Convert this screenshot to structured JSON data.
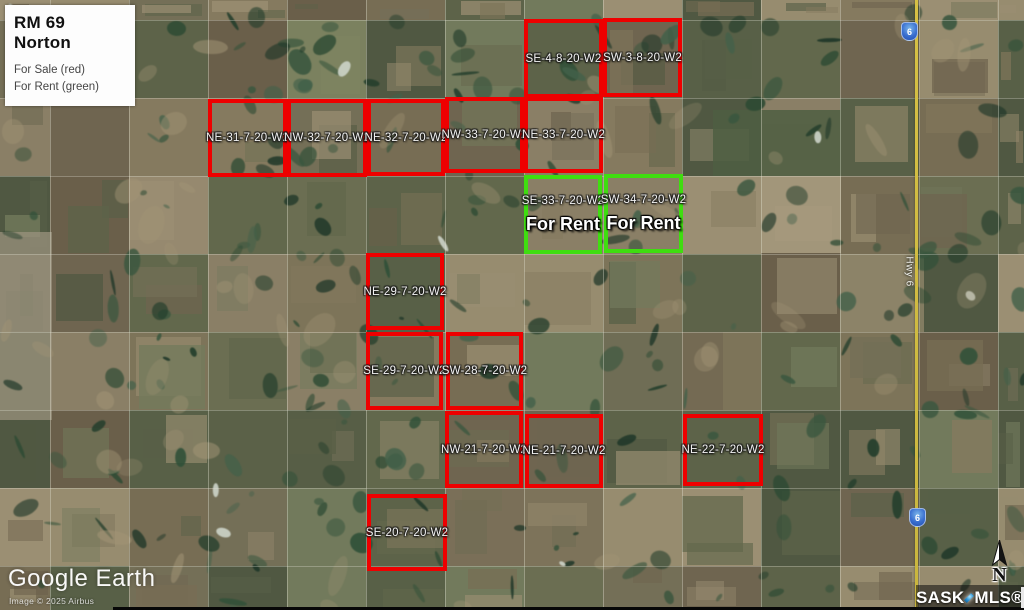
{
  "legend": {
    "title": "RM 69 Norton",
    "line1": "For Sale (red)",
    "line2": "For Rent (green)"
  },
  "colors": {
    "sale": "#ee0000",
    "rent": "#3fdd10"
  },
  "parcels": [
    {
      "label": "SE-4-8-20-W2",
      "status": "sale",
      "x": 524,
      "y": 19,
      "w": 79,
      "h": 79
    },
    {
      "label": "SW-3-8-20-W2",
      "status": "sale",
      "x": 603,
      "y": 18,
      "w": 79,
      "h": 79
    },
    {
      "label": "NE-31-7-20-W2",
      "status": "sale",
      "x": 208,
      "y": 99,
      "w": 79,
      "h": 78
    },
    {
      "label": "NW-32-7-20-W2",
      "status": "sale",
      "x": 287,
      "y": 99,
      "w": 80,
      "h": 78
    },
    {
      "label": "NE-32-7-20-W2",
      "status": "sale",
      "x": 367,
      "y": 99,
      "w": 78,
      "h": 77
    },
    {
      "label": "NW-33-7-20-W2",
      "status": "sale",
      "x": 445,
      "y": 97,
      "w": 79,
      "h": 76
    },
    {
      "label": "NE-33-7-20-W2",
      "status": "sale",
      "x": 524,
      "y": 97,
      "w": 79,
      "h": 76
    },
    {
      "label": "SE-33-7-20-W2",
      "status": "rent",
      "note": "For Rent",
      "x": 524,
      "y": 175,
      "w": 78,
      "h": 79
    },
    {
      "label": "SW-34-7-20-W2",
      "status": "rent",
      "note": "For Rent",
      "x": 604,
      "y": 174,
      "w": 79,
      "h": 79
    },
    {
      "label": "NE-29-7-20-W2",
      "status": "sale",
      "x": 366,
      "y": 253,
      "w": 78,
      "h": 77
    },
    {
      "label": "SE-29-7-20-W2",
      "status": "sale",
      "x": 366,
      "y": 332,
      "w": 77,
      "h": 78
    },
    {
      "label": "SW-28-7-20-W2",
      "status": "sale",
      "x": 446,
      "y": 332,
      "w": 77,
      "h": 78
    },
    {
      "label": "NW-21-7-20-W2",
      "status": "sale",
      "x": 445,
      "y": 411,
      "w": 78,
      "h": 77
    },
    {
      "label": "NE-21-7-20-W2",
      "status": "sale",
      "x": 525,
      "y": 414,
      "w": 78,
      "h": 74
    },
    {
      "label": "NE-22-7-20-W2",
      "status": "sale",
      "x": 683,
      "y": 414,
      "w": 80,
      "h": 72
    },
    {
      "label": "SE-20-7-20-W2",
      "status": "sale",
      "x": 367,
      "y": 494,
      "w": 80,
      "h": 77
    }
  ],
  "highway": {
    "label": "Hwy 6",
    "shield_number": "6"
  },
  "compass": {
    "label": "N"
  },
  "watermarks": {
    "google_earth": "Google Earth",
    "imagery_credit": "Image © 2025 Airbus",
    "mls_sask": "SASK",
    "mls_mls": "MLS®"
  }
}
